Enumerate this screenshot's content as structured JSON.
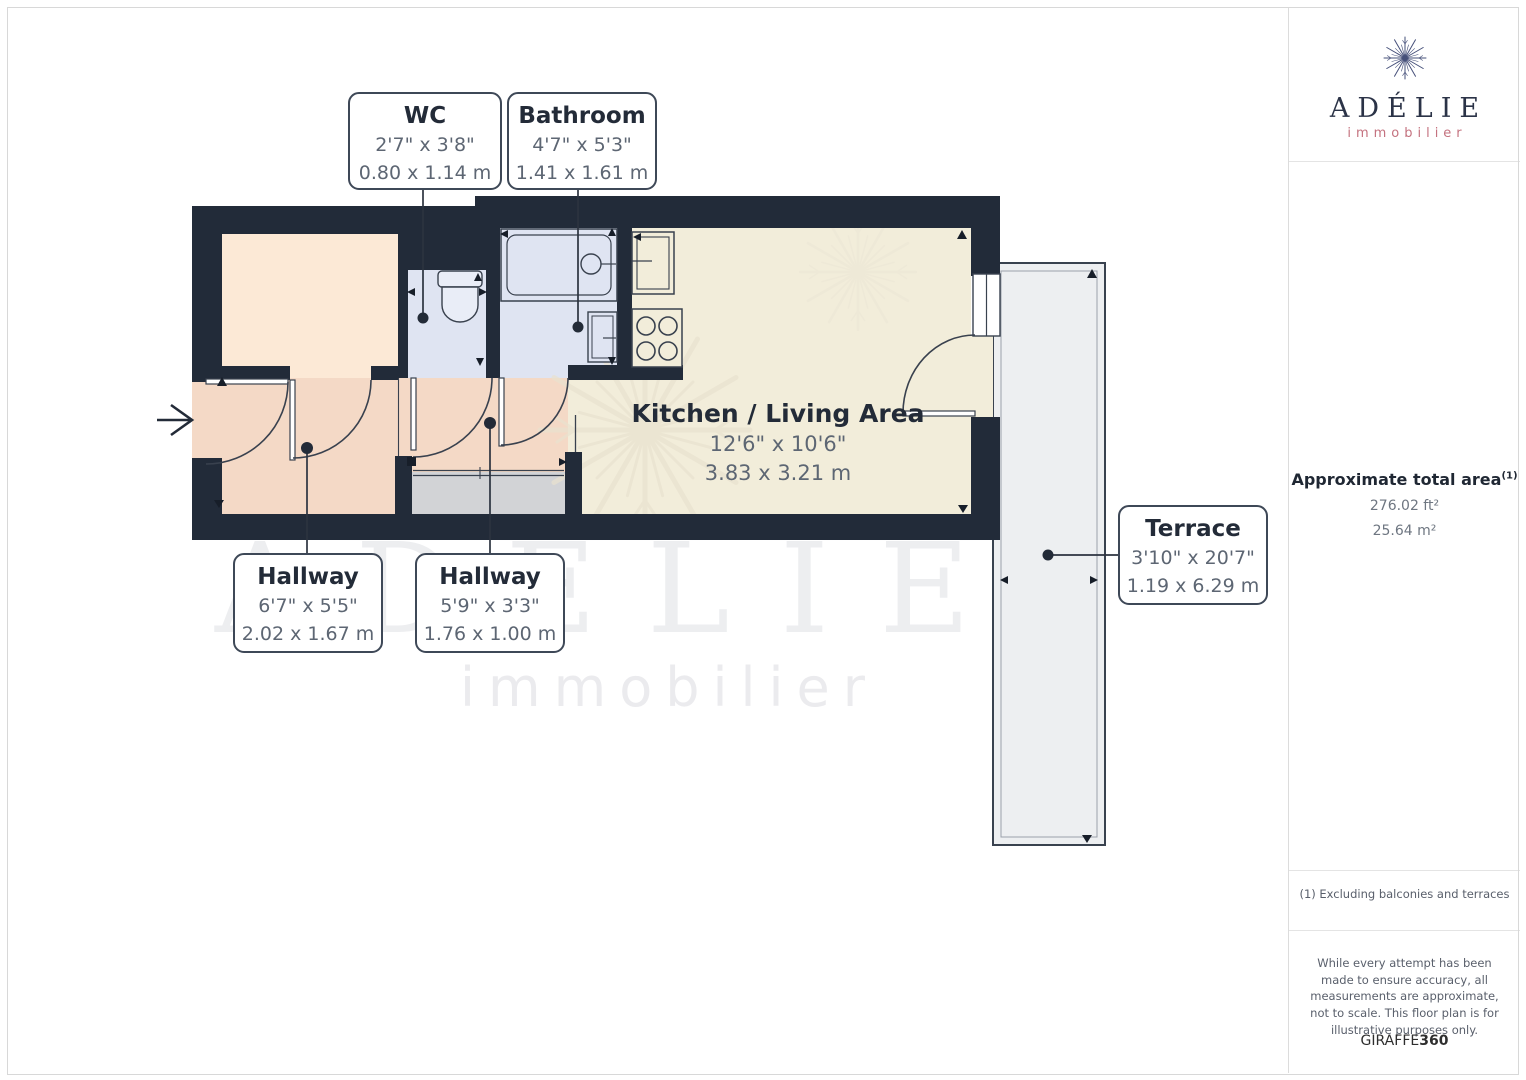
{
  "floor_plan": {
    "rooms": [
      {
        "name": "WC",
        "imperial": "2'7\" x 3'8\"",
        "metric": "0.80 x 1.14 m"
      },
      {
        "name": "Bathroom",
        "imperial": "4'7\" x 5'3\"",
        "metric": "1.41 x 1.61 m"
      },
      {
        "name": "Kitchen / Living Area",
        "imperial": "12'6\" x 10'6\"",
        "metric": "3.83 x 3.21 m"
      },
      {
        "name": "Hallway",
        "imperial": "6'7\" x 5'5\"",
        "metric": "2.02 x 1.67 m"
      },
      {
        "name": "Hallway",
        "imperial": "5'9\" x 3'3\"",
        "metric": "1.76 x 1.00 m"
      },
      {
        "name": "Terrace",
        "imperial": "3'10\" x 20'7\"",
        "metric": "1.19 x 6.29 m"
      }
    ],
    "watermark_title": "ADELIE",
    "watermark_subtitle": "immobilier"
  },
  "sidebar": {
    "brand": "ADÉLIE",
    "tagline": "immobilier",
    "area_label": "Approximate total area",
    "area_sup": "(1)",
    "area_ft": "276.02 ft²",
    "area_m": "25.64 m²",
    "footnote": "(1) Excluding balconies and terraces",
    "disclaimer": "While every attempt has been made to ensure accuracy, all measurements are approximate, not to scale. This floor plan is for illustrative purposes only.",
    "giraffe": "GIRAFFE",
    "giraffe_suffix": "360"
  },
  "colors": {
    "wall": "#222b39",
    "hallway_floor": "#f4d9c6",
    "bedroom_floor": "#fce9d6",
    "wet_room_floor": "#dfe4f2",
    "living_floor": "#f2edda",
    "closet_floor": "#d2d3d6",
    "terrace_floor": "#edeff1",
    "brand_rose": "#c4727f",
    "brand_navy": "#2b3347"
  }
}
